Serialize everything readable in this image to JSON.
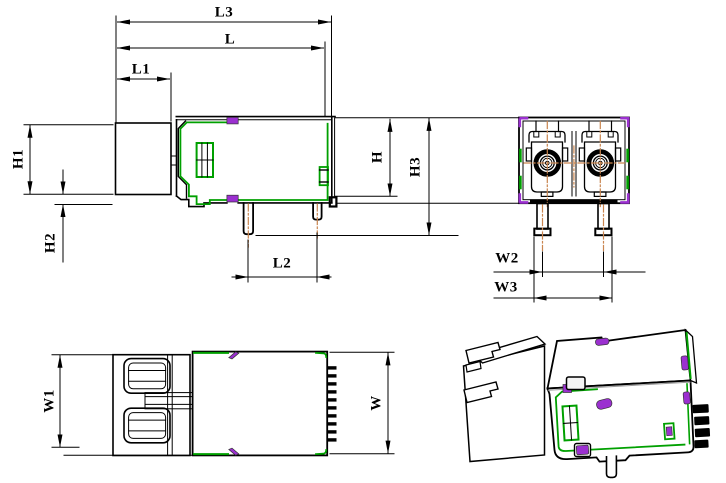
{
  "drawing": {
    "title": "Dual LC fiber-optic connector receptacle - dimensioned engineering drawing",
    "views": [
      "side view",
      "front view",
      "top view",
      "isometric view"
    ],
    "dim_labels": {
      "L3": "L3",
      "L": "L",
      "L1": "L1",
      "L2": "L2",
      "H": "H",
      "H1": "H1",
      "H2": "H2",
      "H3": "H3",
      "W": "W",
      "W1": "W1",
      "W2": "W2",
      "W3": "W3"
    },
    "colors": {
      "line": "#000000",
      "green": "#00a000",
      "purple": "#9b30d0",
      "centerline": "#c9854f",
      "background": "#ffffff"
    }
  }
}
